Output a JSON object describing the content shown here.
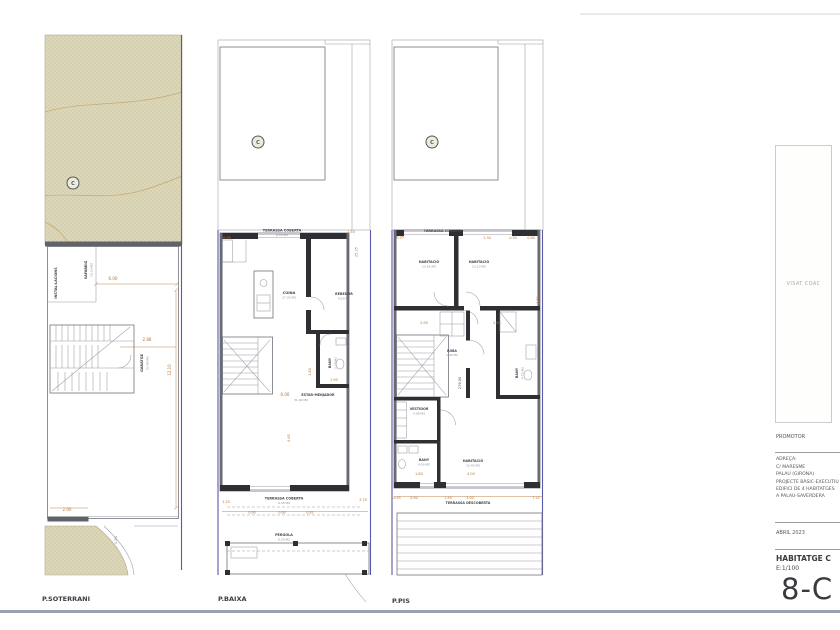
{
  "colors": {
    "dimension_text": "#b5763a",
    "wall": "#2e2e33",
    "plot_boundary_blue": "#5a5aa8",
    "terrain_fill": "#dcd7b8",
    "sheet_border": "#99a0b5"
  },
  "plans": [
    {
      "id": "soterrani",
      "footer": "P.SOTERRANI",
      "labels": [
        {
          "t": "C",
          "x": 73,
          "y": 185,
          "c": "marker",
          "s": 5
        },
        {
          "t": "INSTAL·LACIONS",
          "x": 57,
          "y": 283,
          "r": -90,
          "c": "room",
          "s": 3.4
        },
        {
          "t": "SAFAREIG",
          "x": 87,
          "y": 270,
          "r": -90,
          "c": "room",
          "s": 3.4
        },
        {
          "t": "10.10 M2",
          "x": 92.5,
          "y": 270,
          "r": -90,
          "c": "area",
          "s": 3
        },
        {
          "t": "6.00",
          "x": 113,
          "y": 280,
          "c": "dim",
          "s": 4
        },
        {
          "t": "2.88",
          "x": 147,
          "y": 341,
          "c": "dim",
          "s": 4
        },
        {
          "t": "GARATGE",
          "x": 143,
          "y": 363,
          "r": -90,
          "c": "room",
          "s": 3.4
        },
        {
          "t": "53.90 M2",
          "x": 148.5,
          "y": 363,
          "r": -90,
          "c": "area",
          "s": 3
        },
        {
          "t": "12.10",
          "x": 171,
          "y": 370,
          "r": -90,
          "c": "dim",
          "s": 4
        },
        {
          "t": "2.00",
          "x": 67,
          "y": 511,
          "c": "dim",
          "s": 4
        },
        {
          "t": "4.5%",
          "x": 117,
          "y": 540,
          "r": -90,
          "c": "area",
          "s": 3.2
        }
      ]
    },
    {
      "id": "baixa",
      "footer": "P.BAIXA",
      "labels": [
        {
          "t": "C",
          "x": 258,
          "y": 144,
          "c": "marker",
          "s": 5
        },
        {
          "t": "TERRASSA COBERTA",
          "x": 282,
          "y": 231.5,
          "c": "room",
          "s": 3.4
        },
        {
          "t": "6.55 M2",
          "x": 282,
          "y": 236,
          "c": "area",
          "s": 3
        },
        {
          "t": "0.95",
          "x": 227,
          "y": 239,
          "c": "dim",
          "s": 3.5
        },
        {
          "t": "1.50",
          "x": 351,
          "y": 233,
          "c": "dim",
          "s": 3.5
        },
        {
          "t": "25.35",
          "x": 357.5,
          "y": 252,
          "r": -90,
          "c": "dim",
          "s": 3.5
        },
        {
          "t": "CUINA",
          "x": 289,
          "y": 294,
          "c": "room",
          "s": 3.6
        },
        {
          "t": "17.30 M2",
          "x": 289,
          "y": 298.5,
          "c": "area",
          "s": 3
        },
        {
          "t": "REBEDOR",
          "x": 344,
          "y": 295,
          "c": "room",
          "s": 3.3
        },
        {
          "t": "4.50 M2",
          "x": 344,
          "y": 299.5,
          "c": "area",
          "s": 3
        },
        {
          "t": "BANY",
          "x": 331,
          "y": 363,
          "r": -90,
          "c": "room",
          "s": 3.3
        },
        {
          "t": "3.50 M2",
          "x": 336.5,
          "y": 363,
          "r": -90,
          "c": "area",
          "s": 3
        },
        {
          "t": "1.80",
          "x": 311,
          "y": 372,
          "r": -90,
          "c": "dim",
          "s": 3.5
        },
        {
          "t": "1.90",
          "x": 334,
          "y": 381,
          "c": "dim",
          "s": 3.5
        },
        {
          "t": "6.00",
          "x": 285,
          "y": 396,
          "c": "dim",
          "s": 4
        },
        {
          "t": "ESTAR-MENJADOR",
          "x": 318,
          "y": 396,
          "c": "room",
          "s": 3.3
        },
        {
          "t": "31.90 M2",
          "x": 301,
          "y": 401,
          "c": "area",
          "s": 3
        },
        {
          "t": "4.95",
          "x": 290,
          "y": 438,
          "r": -90,
          "c": "dim",
          "s": 3.5
        },
        {
          "t": "1.25",
          "x": 226,
          "y": 503,
          "c": "dim",
          "s": 3.5
        },
        {
          "t": "TERRASSA COBERTA",
          "x": 284,
          "y": 499.5,
          "c": "room",
          "s": 3.4
        },
        {
          "t": "4.35 M2",
          "x": 284,
          "y": 504,
          "c": "area",
          "s": 3
        },
        {
          "t": "3.70",
          "x": 363,
          "y": 501,
          "c": "dim",
          "s": 3.5
        },
        {
          "t": "0.60",
          "x": 252,
          "y": 513.5,
          "c": "dim",
          "s": 3.3
        },
        {
          "t": "0.60",
          "x": 282,
          "y": 513.5,
          "c": "dim",
          "s": 3.3
        },
        {
          "t": "0.82",
          "x": 310,
          "y": 513.5,
          "c": "dim",
          "s": 3.3
        },
        {
          "t": "PERGOLA",
          "x": 284,
          "y": 536,
          "c": "room",
          "s": 3.4
        },
        {
          "t": "6.20 M2",
          "x": 284,
          "y": 540.5,
          "c": "area",
          "s": 3
        }
      ]
    },
    {
      "id": "pis",
      "footer": "P.PIS",
      "labels": [
        {
          "t": "C",
          "x": 432,
          "y": 144,
          "c": "marker",
          "s": 5
        },
        {
          "t": "TERRASSA COBERTA",
          "x": 443,
          "y": 232,
          "c": "room",
          "s": 3.4
        },
        {
          "t": "0.95",
          "x": 400,
          "y": 238.5,
          "c": "dim",
          "s": 3.3
        },
        {
          "t": "2.30",
          "x": 487,
          "y": 239,
          "c": "dim",
          "s": 3.3
        },
        {
          "t": "0.50",
          "x": 513,
          "y": 239,
          "c": "dim",
          "s": 3.3
        },
        {
          "t": "0.90",
          "x": 531,
          "y": 239,
          "c": "dim",
          "s": 3.3
        },
        {
          "t": "HABITACIÓ",
          "x": 429,
          "y": 263,
          "c": "room",
          "s": 3.4
        },
        {
          "t": "13.55 M2",
          "x": 429,
          "y": 267.5,
          "c": "area",
          "s": 3
        },
        {
          "t": "HABITACIÓ",
          "x": 479,
          "y": 263,
          "c": "room",
          "s": 3.4
        },
        {
          "t": "13.10 M2",
          "x": 479,
          "y": 267.5,
          "c": "area",
          "s": 3
        },
        {
          "t": "2.95",
          "x": 424,
          "y": 324,
          "c": "dim",
          "s": 3.5
        },
        {
          "t": "2.85",
          "x": 497,
          "y": 324,
          "c": "dim",
          "s": 3.5
        },
        {
          "t": "ROBA",
          "x": 452,
          "y": 352,
          "c": "room",
          "s": 3.1
        },
        {
          "t": "1.40 M2",
          "x": 452,
          "y": 356,
          "c": "area",
          "s": 2.9
        },
        {
          "t": "279.00",
          "x": 461,
          "y": 383,
          "r": -90,
          "c": "note",
          "s": 3.5
        },
        {
          "t": "BANY",
          "x": 518,
          "y": 373,
          "r": -90,
          "c": "room",
          "s": 3.3
        },
        {
          "t": "4.75 M2",
          "x": 523.5,
          "y": 373,
          "r": -90,
          "c": "area",
          "s": 3
        },
        {
          "t": "2.50",
          "x": 539,
          "y": 300,
          "r": -90,
          "c": "dim",
          "s": 3.3
        },
        {
          "t": "VESTIDOR",
          "x": 419,
          "y": 410,
          "c": "room",
          "s": 3.3
        },
        {
          "t": "4.08 M2",
          "x": 419,
          "y": 414.5,
          "c": "area",
          "s": 3
        },
        {
          "t": "BANY",
          "x": 424,
          "y": 461,
          "c": "room",
          "s": 3.3
        },
        {
          "t": "4.00 M2",
          "x": 424,
          "y": 465.5,
          "c": "area",
          "s": 3
        },
        {
          "t": "1.80",
          "x": 419,
          "y": 475,
          "c": "dim",
          "s": 3.5
        },
        {
          "t": "HABITACIÓ",
          "x": 473,
          "y": 462,
          "c": "room",
          "s": 3.4
        },
        {
          "t": "15.40 M2",
          "x": 473,
          "y": 466.5,
          "c": "area",
          "s": 3
        },
        {
          "t": "4.00",
          "x": 471,
          "y": 475,
          "c": "dim",
          "s": 3.5
        },
        {
          "t": "0.95",
          "x": 397,
          "y": 499,
          "c": "dim",
          "s": 3.3
        },
        {
          "t": "0.90",
          "x": 414,
          "y": 499,
          "c": "dim",
          "s": 3.3
        },
        {
          "t": "1.95",
          "x": 448,
          "y": 499,
          "c": "dim",
          "s": 3.3
        },
        {
          "t": "1.00",
          "x": 470,
          "y": 499,
          "c": "dim",
          "s": 3.3
        },
        {
          "t": "7.25",
          "x": 536,
          "y": 499,
          "c": "dim",
          "s": 3.3
        },
        {
          "t": "TERRASSA DESCOBERTA",
          "x": 468,
          "y": 504,
          "c": "room",
          "s": 3.3
        }
      ]
    }
  ],
  "titleblock": {
    "visat_stamp": "VISAT COAC",
    "promotor_label": "PROMOTOR",
    "address_label": "ADREÇA:",
    "address_line1": "C/ MARESME",
    "address_line2": "PALAU (GIRONA)",
    "project_line1": "PROJECTE BÀSIC-EXECUTIU",
    "project_line2": "EDIFICI DE 4 HABITATGES",
    "project_line3": "A PALAU-SAVERDERA",
    "date": "ABRIL 2023",
    "dwelling": "HABITATGE C",
    "scale": "E:1/100",
    "sheet_number": "8-C"
  }
}
